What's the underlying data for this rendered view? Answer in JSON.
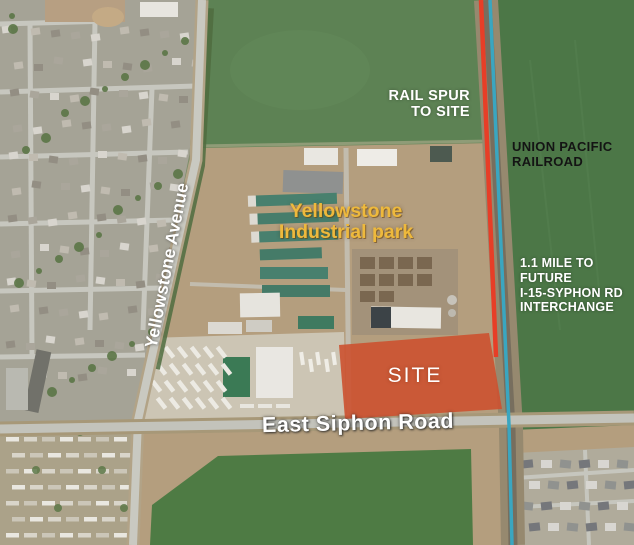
{
  "title": "Yellowstone Industrial Park aerial site map",
  "labels": {
    "rail_spur": "RAIL SPUR\nTO SITE",
    "union_pacific_railroad": "UNION PACIFIC\nRAILROAD",
    "interchange_distance": "1.1 MILE TO\nFUTURE\nI-15-SYPHON RD\nINTERCHANGE",
    "industrial_park": "Yellowstone\nIndustrial park",
    "yellowstone_avenue": "Yellowstone Avenue",
    "site": "SITE",
    "east_siphon_road": "East Siphon Road"
  },
  "colors": {
    "site_overlay": "#cc5130",
    "rail_spur_highlight": "#e73e27",
    "railroad_highlight": "#3aa6c0",
    "industrial_park_label": "#eeb93c",
    "map_label_text": "#ffffff",
    "railroad_label_text": "#141414"
  }
}
